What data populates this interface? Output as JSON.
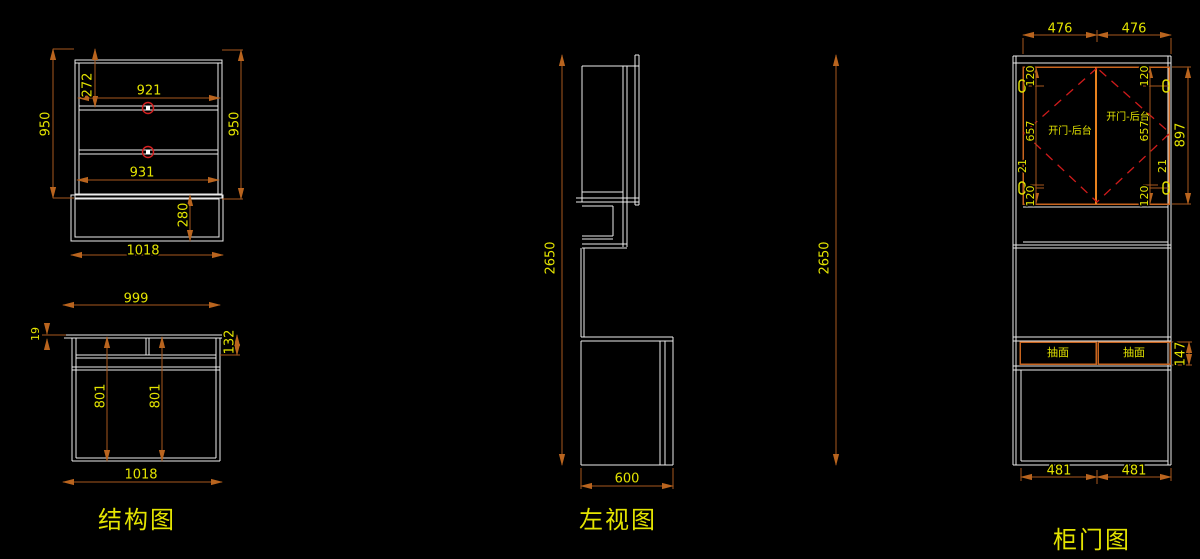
{
  "colors": {
    "background": "#000000",
    "drawing_line": "#ECECEC",
    "dimension_line": "#A8591E",
    "dimension_text": "#E4E400",
    "door_frame": "#C8641E",
    "swing_dash": "#CF1B1B"
  },
  "views": {
    "structure": {
      "title": "结构图",
      "upper": {
        "height_left": "950",
        "height_right": "950",
        "top_section": "272",
        "inner_width_top": "921",
        "inner_width_bottom": "931",
        "base_height": "280",
        "total_width": "1018"
      },
      "desk": {
        "top_width": "999",
        "top_thickness": "19",
        "front_rail": "132",
        "depth_left": "801",
        "depth_right": "801",
        "total_width": "1018"
      }
    },
    "side": {
      "title": "左视图",
      "total_height": "2650",
      "depth": "600"
    },
    "doors": {
      "title": "柜门图",
      "top_widths": [
        "476",
        "476"
      ],
      "door_height": "897",
      "total_height": "2650",
      "left_chain": [
        "120",
        "657",
        "21",
        "120"
      ],
      "right_chain": [
        "120",
        "657",
        "21",
        "120"
      ],
      "door_text": "开门-后台",
      "drawer_text": "抽面",
      "drawer_height": "147",
      "bottom_widths": [
        "481",
        "481"
      ]
    }
  }
}
